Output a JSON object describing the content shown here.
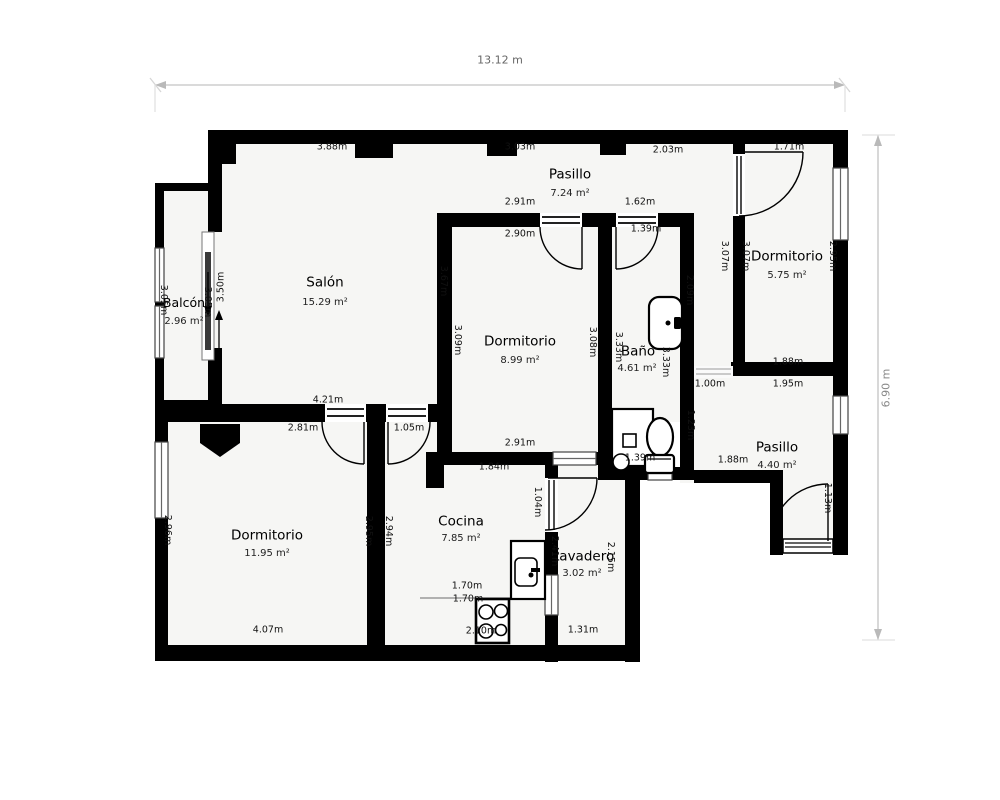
{
  "dimensions": {
    "overall_width": "13.12 m",
    "overall_height": "6.90 m"
  },
  "rooms": {
    "salon": {
      "name": "Salón",
      "area": "15.29 m²"
    },
    "balcon": {
      "name": "Balcón",
      "area": "2.96 m²"
    },
    "pasillo_top": {
      "name": "Pasillo",
      "area": "7.24 m²"
    },
    "dorm_tr": {
      "name": "Dormitorio",
      "area": "5.75 m²"
    },
    "dorm_mid": {
      "name": "Dormitorio",
      "area": "8.99 m²"
    },
    "bano": {
      "name": "Baño",
      "area": "4.61 m²"
    },
    "pasillo_r": {
      "name": "Pasillo",
      "area": "4.40 m²"
    },
    "dorm_bl": {
      "name": "Dormitorio",
      "area": "11.95 m²"
    },
    "cocina": {
      "name": "Cocina",
      "area": "7.85 m²"
    },
    "lavadero": {
      "name": "Lavadero",
      "area": "3.02 m²"
    }
  },
  "measurements": {
    "salon_top": "3.88m",
    "pasillo_top_left": "3.03m",
    "pasillo_top_right": "2.03m",
    "dorm_tr_top": "1.71m",
    "pasillo_bot_left": "2.91m",
    "pasillo_bot_right": "1.62m",
    "dorm_mid_top": "2.90m",
    "bano_top": "1.39m",
    "dorm_tr_bottom": "1.88m",
    "strip_bottom": "1.00m",
    "pasillo_r_top": "1.95m",
    "pasillo_r_bottom": "1.88m",
    "salon_bottom": "4.21m",
    "dorm_bl_top": "2.81m",
    "cocina_door": "1.05m",
    "dorm_mid_bottom": "2.91m",
    "cocina_top": "1.84m",
    "bano_bottom": "1.39m",
    "counter1": "1.70m",
    "counter2": "1.70m",
    "cocina_bottom": "2.10m",
    "dorm_bl_bottom": "4.07m",
    "lavadero_bottom": "1.31m",
    "balcon_left": "3.05m",
    "balcon_slider": "3.05m",
    "salon_west": "3.50m",
    "salon_east": "3.67m",
    "dorm_mid_left": "3.09m",
    "dorm_mid_right": "3.08m",
    "bano_left": "3.33m",
    "bano_right": "3.33m",
    "strip_left": "2.09m",
    "strip_wall": "3.07m",
    "dorm_tr_left": "3.07m",
    "dorm_tr_right": "2.95m",
    "pasillo_r_left": "1.23m",
    "entry_door": "1.13m",
    "dorm_bl_left": "2.96m",
    "dorm_bl_right": "2.95m",
    "cocina_left": "2.94m",
    "lav_door": "1.04m",
    "lavadero_left": "2.41m",
    "lavadero_right": "2.15m"
  },
  "symbols": {
    "toilet": "toilet-top-view",
    "shower": "shower-tray-with-drain",
    "bath_sink": "washbasin",
    "kitchen_sink": "kitchen-sink-counter",
    "stove": "stove-4-burners",
    "sliding_door": "sliding-door-arrows",
    "doors": "door-swing-arc",
    "windows": "double-line-window"
  },
  "colors": {
    "wall": "#000000",
    "floor": "#f6f6f4",
    "dim_line": "#c4c4c4",
    "dim_text": "#666666"
  }
}
